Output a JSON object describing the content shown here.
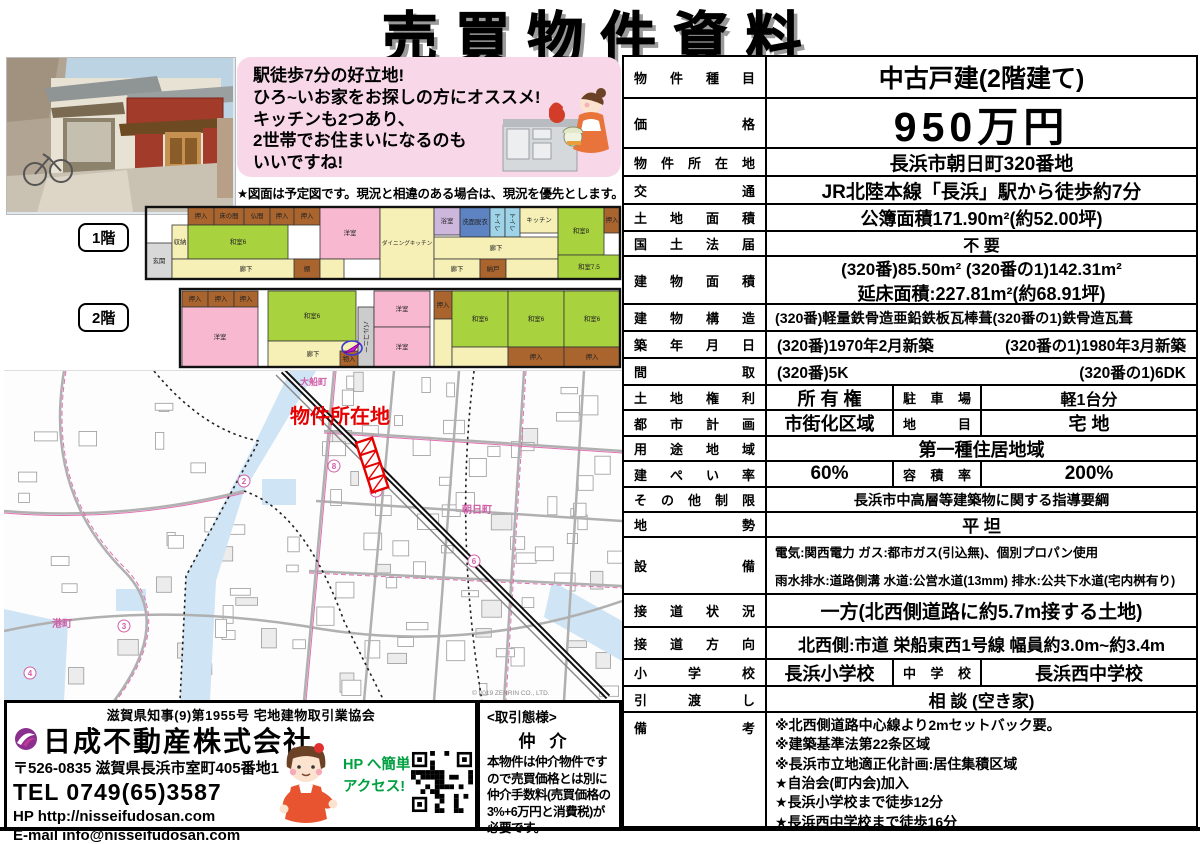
{
  "title": "売買物件資料",
  "promo": {
    "lines": [
      "駅徒歩7分の好立地!",
      "ひろ~いお家をお探しの方にオススメ!",
      "キッチンも2つあり、",
      "2世帯でお住まいになるのも",
      "いいですね!"
    ],
    "figure_note": "★図面は予定図です。現況と相違のある場合は、現況を優先とします。"
  },
  "floorplan": {
    "floor1_label": "1階",
    "floor2_label": "2階",
    "room_colors": {
      "tatami": "#a9d23f",
      "western": "#f8b9d0",
      "hall": "#f6efb6",
      "wet": "#5d83c2",
      "toilet": "#9fd4e8",
      "closet": "#aa652f",
      "balcony": "#cccccc",
      "genkan": "#d8d8d8",
      "bath": "#cdb7dd"
    },
    "floor1_rooms": [
      {
        "n": "玄関",
        "t": "genkan",
        "r": [
          2,
          40,
          26,
          36
        ]
      },
      {
        "n": "収納",
        "t": "hall",
        "r": [
          28,
          22,
          16,
          34
        ]
      },
      {
        "n": "押入",
        "t": "closet",
        "r": [
          44,
          4,
          26,
          18
        ]
      },
      {
        "n": "床の間",
        "t": "closet",
        "r": [
          70,
          4,
          30,
          18
        ]
      },
      {
        "n": "仏間",
        "t": "closet",
        "r": [
          100,
          4,
          26,
          18
        ]
      },
      {
        "n": "押入",
        "t": "closet",
        "r": [
          126,
          4,
          24,
          18
        ]
      },
      {
        "n": "押入",
        "t": "closet",
        "r": [
          150,
          4,
          26,
          18
        ]
      },
      {
        "n": "和室6",
        "t": "tatami",
        "r": [
          44,
          22,
          100,
          34
        ]
      },
      {
        "n": "廊下",
        "t": "hall",
        "r": [
          28,
          56,
          148,
          20
        ]
      },
      {
        "n": "棚",
        "t": "closet",
        "r": [
          150,
          56,
          26,
          20
        ]
      },
      {
        "n": "洋室",
        "t": "western",
        "r": [
          176,
          4,
          60,
          52
        ]
      },
      {
        "n": "",
        "t": "hall",
        "r": [
          176,
          56,
          24,
          20
        ]
      },
      {
        "n": "ダイニングキッチン",
        "t": "hall",
        "r": [
          236,
          4,
          54,
          72
        ]
      },
      {
        "n": "浴室",
        "t": "bath",
        "r": [
          290,
          4,
          26,
          28
        ]
      },
      {
        "n": "洗面脱衣",
        "t": "wet",
        "r": [
          316,
          4,
          30,
          30
        ]
      },
      {
        "n": "トイレ",
        "t": "toilet",
        "r": [
          346,
          4,
          15,
          30
        ],
        "v": 1
      },
      {
        "n": "トイレ",
        "t": "toilet",
        "r": [
          361,
          4,
          15,
          30
        ],
        "v": 1
      },
      {
        "n": "キッチン",
        "t": "hall",
        "r": [
          376,
          4,
          38,
          26
        ]
      },
      {
        "n": "廊下",
        "t": "hall",
        "r": [
          290,
          34,
          124,
          22
        ]
      },
      {
        "n": "廊下",
        "t": "hall",
        "r": [
          290,
          56,
          46,
          20
        ]
      },
      {
        "n": "納戸",
        "t": "closet",
        "r": [
          336,
          56,
          26,
          20
        ]
      },
      {
        "n": "",
        "t": "hall",
        "r": [
          362,
          56,
          52,
          20
        ]
      },
      {
        "n": "和室8",
        "t": "tatami",
        "r": [
          414,
          4,
          46,
          48
        ]
      },
      {
        "n": "押入",
        "t": "closet",
        "r": [
          460,
          4,
          16,
          26
        ]
      },
      {
        "n": "和室7.5",
        "t": "tatami",
        "r": [
          414,
          52,
          62,
          24
        ]
      }
    ],
    "floor2_rooms": [
      {
        "n": "押入",
        "t": "closet",
        "r": [
          38,
          88,
          26,
          16
        ]
      },
      {
        "n": "押入",
        "t": "closet",
        "r": [
          64,
          88,
          26,
          16
        ]
      },
      {
        "n": "押入",
        "t": "closet",
        "r": [
          90,
          88,
          24,
          16
        ]
      },
      {
        "n": "洋室",
        "t": "western",
        "r": [
          38,
          104,
          76,
          60
        ]
      },
      {
        "n": "和室6",
        "t": "tatami",
        "r": [
          124,
          88,
          88,
          50
        ]
      },
      {
        "n": "廊下",
        "t": "hall",
        "r": [
          124,
          138,
          90,
          26
        ]
      },
      {
        "n": "物入",
        "t": "closet",
        "r": [
          196,
          148,
          18,
          16
        ]
      },
      {
        "n": "バルコニー",
        "t": "balcony",
        "r": [
          214,
          104,
          16,
          60
        ],
        "v": 1
      },
      {
        "n": "洋室",
        "t": "western",
        "r": [
          230,
          88,
          56,
          36
        ]
      },
      {
        "n": "洋室",
        "t": "western",
        "r": [
          230,
          124,
          56,
          40
        ]
      },
      {
        "n": "押入",
        "t": "closet",
        "r": [
          290,
          88,
          18,
          28
        ]
      },
      {
        "n": "",
        "t": "hall",
        "r": [
          290,
          116,
          18,
          48
        ]
      },
      {
        "n": "和室6",
        "t": "tatami",
        "r": [
          308,
          88,
          56,
          56
        ]
      },
      {
        "n": "和室6",
        "t": "tatami",
        "r": [
          364,
          88,
          56,
          56
        ]
      },
      {
        "n": "和室6",
        "t": "tatami",
        "r": [
          420,
          88,
          56,
          56
        ]
      },
      {
        "n": "",
        "t": "hall",
        "r": [
          308,
          144,
          56,
          20
        ]
      },
      {
        "n": "押入",
        "t": "closet",
        "r": [
          364,
          144,
          56,
          20
        ]
      },
      {
        "n": "押入",
        "t": "closet",
        "r": [
          420,
          144,
          56,
          20
        ]
      }
    ]
  },
  "map": {
    "location_label": "物件所在地",
    "location_color": "#e60000",
    "town_labels": [
      "大船町",
      "朝日町",
      "港町"
    ],
    "copyright": "© 2019 ZENRIN CO., LTD."
  },
  "company": {
    "license": "滋賀県知事(9)第1955号 宅地建物取引業協会",
    "name": "日成不動産株式会社",
    "address": "〒526-0835 滋賀県長浜市室町405番地1",
    "tel": "TEL 0749(65)3587",
    "hp": "HP http://nisseifudosan.com",
    "email": "E-mail info@nisseifudosan.com",
    "hp_access_line1": "HP へ簡単",
    "hp_access_line2": "アクセス!",
    "accent_green": "#00a040",
    "logo_color": "#8b2f8f"
  },
  "deal": {
    "header": "<取引態様>",
    "type": "仲介",
    "body": "本物件は仲介物件ですので売買価格とは別に仲介手数料(売買価格の3%+6万円と消費税)が必要です。"
  },
  "table": {
    "rows": [
      {
        "label": "物件種目",
        "value": "中古戸建(2階建て)"
      },
      {
        "label": "価格",
        "value": "950万円"
      },
      {
        "label": "物件所在地",
        "value": "長浜市朝日町320番地"
      },
      {
        "label": "交通",
        "value": "JR北陸本線「長浜」駅から徒歩約7分"
      },
      {
        "label": "土地面積",
        "value": "公簿面積171.90m²(約52.00坪)"
      },
      {
        "label": "国土法届",
        "value": "不  要"
      },
      {
        "label": "建物面積",
        "line1": "(320番)85.50m² (320番の1)142.31m²",
        "line2": "延床面積:227.81m²(約68.91坪)"
      },
      {
        "label": "建物構造",
        "value": "(320番)軽量鉄骨造亜鉛鉄板瓦棒葺(320番の1)鉄骨造瓦葺"
      },
      {
        "label": "築年月日",
        "left": "(320番)1970年2月新築",
        "right": "(320番の1)1980年3月新築"
      },
      {
        "label": "間取",
        "left": "(320番)5K",
        "right": "(320番の1)6DK"
      },
      {
        "label": "土地権利",
        "value": "所 有 権",
        "sublabel": "駐車場",
        "value2": "軽1台分"
      },
      {
        "label": "都市計画",
        "value": "市街化区域",
        "sublabel": "地目",
        "value2": "宅  地"
      },
      {
        "label": "用途地域",
        "value": "第一種住居地域"
      },
      {
        "label": "建ぺい率",
        "value": "60%",
        "sublabel": "容積率",
        "value2": "200%"
      },
      {
        "label": "その他制限",
        "value": "長浜市中高層等建築物に関する指導要綱"
      },
      {
        "label": "地勢",
        "value": "平  坦"
      },
      {
        "label": "設備",
        "line1": "電気:関西電力 ガス:都市ガス(引込無)、個別プロパン使用",
        "line2": "雨水排水:道路側溝 水道:公営水道(13mm) 排水:公共下水道(宅内桝有り)"
      },
      {
        "label": "接道状況",
        "value": "一方(北西側道路に約5.7m接する土地)"
      },
      {
        "label": "接道方向",
        "value": "北西側:市道 栄船東西1号線 幅員約3.0m~約3.4m"
      },
      {
        "label": "小学校",
        "value": "長浜小学校",
        "sublabel": "中学校",
        "value2": "長浜西中学校"
      },
      {
        "label": "引渡し",
        "value": "相 談 (空き家)"
      },
      {
        "label": "備考",
        "lines": [
          "※北西側道路中心線より2mセットバック要。",
          "※建築基準法第22条区域",
          "※長浜市立地適正化計画:居住集積区域",
          "★自治会(町内会)加入",
          "★長浜小学校まで徒歩12分",
          "★長浜西中学校まで徒歩16分"
        ]
      }
    ]
  }
}
